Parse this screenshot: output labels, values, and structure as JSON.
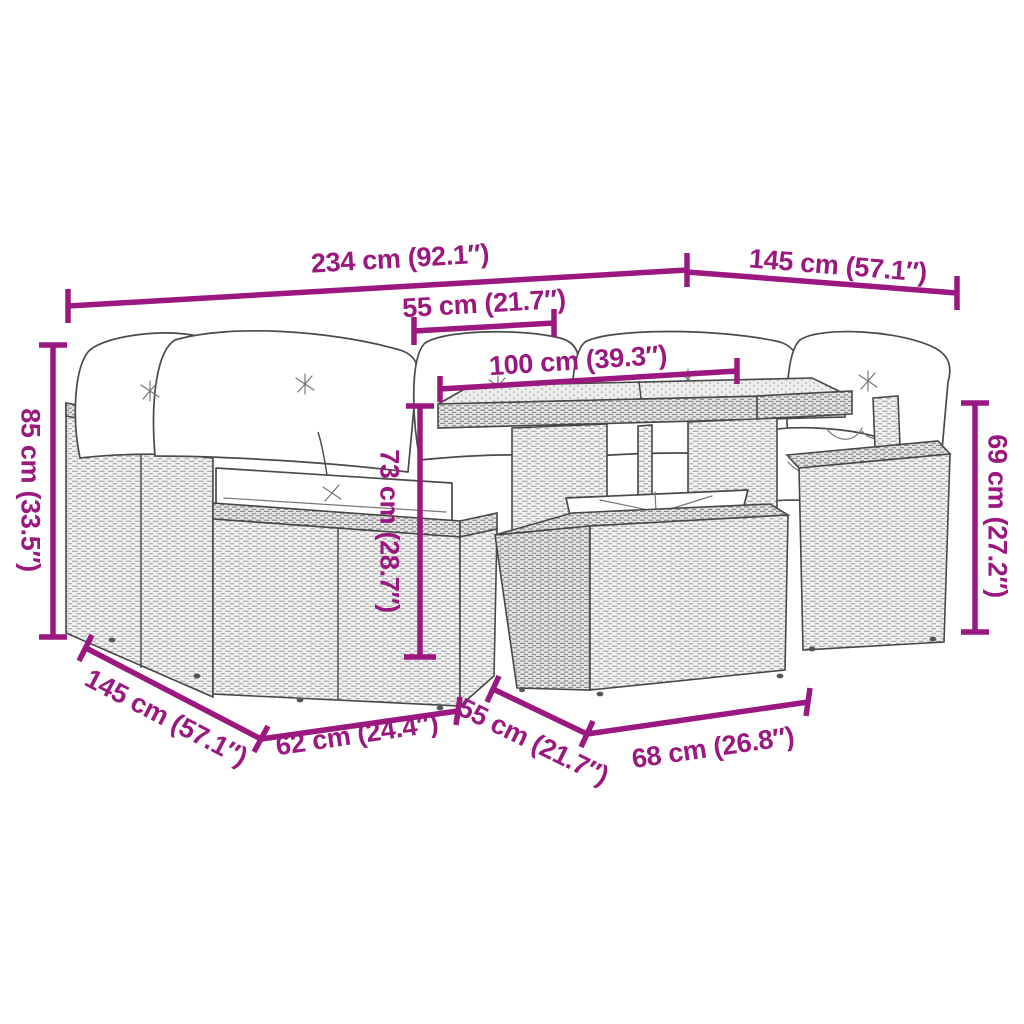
{
  "diagram": {
    "type": "product-dimension-diagram",
    "subject": "rattan garden lounge set with dining table, ottoman and cushions",
    "background_color": "#ffffff",
    "accent_color": "#9a187f",
    "line_art_color": "#474747",
    "dimensions": {
      "overall_width": {
        "label": "234 cm (92.1″)",
        "cm": 234,
        "inches": 92.1
      },
      "right_depth": {
        "label": "145 cm (57.1″)",
        "cm": 145,
        "inches": 57.1
      },
      "table_inset": {
        "label": "55 cm (21.7″)",
        "cm": 55,
        "inches": 21.7
      },
      "table_length": {
        "label": "100 cm (39.3″)",
        "cm": 100,
        "inches": 39.3
      },
      "backrest_height": {
        "label": "85 cm (33.5″)",
        "cm": 85,
        "inches": 33.5
      },
      "table_height": {
        "label": "73 cm (28.7″)",
        "cm": 73,
        "inches": 28.7
      },
      "side_unit_height": {
        "label": "69 cm (27.2″)",
        "cm": 69,
        "inches": 27.2
      },
      "left_depth": {
        "label": "145 cm (57.1″)",
        "cm": 145,
        "inches": 57.1
      },
      "seat_module_width": {
        "label": "62 cm (24.4″)",
        "cm": 62,
        "inches": 24.4
      },
      "ottoman_depth": {
        "label": "55 cm (21.7″)",
        "cm": 55,
        "inches": 21.7
      },
      "ottoman_width": {
        "label": "68 cm (26.8″)",
        "cm": 68,
        "inches": 26.8
      }
    }
  }
}
